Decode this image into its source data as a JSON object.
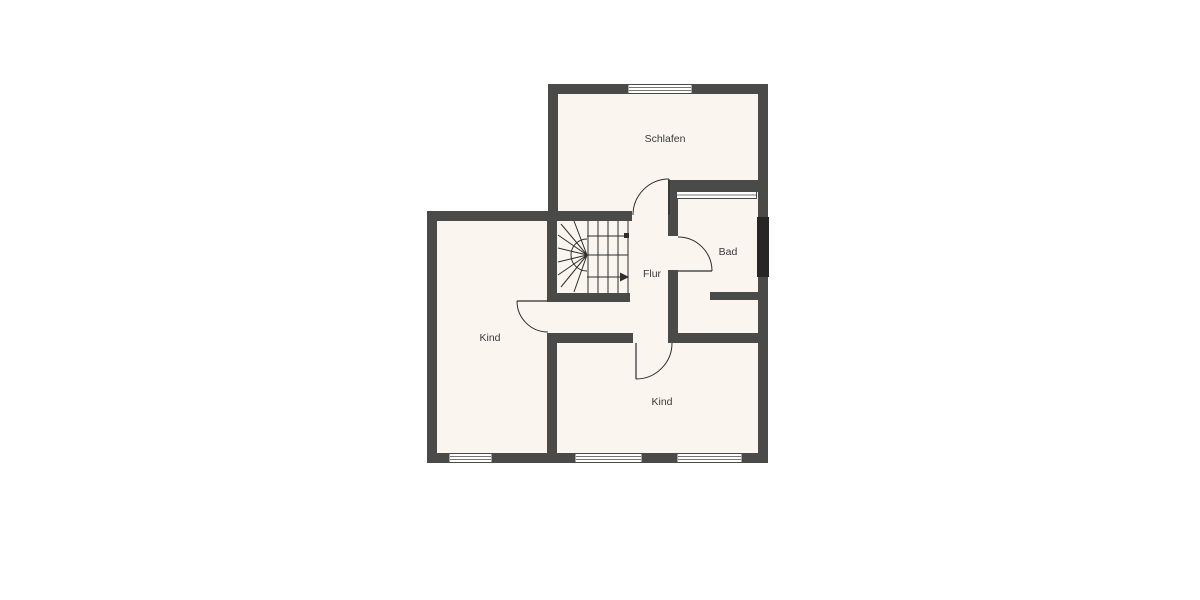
{
  "floorplan": {
    "rooms": [
      {
        "id": "schlafen",
        "label": "Schlafen"
      },
      {
        "id": "bad",
        "label": "Bad"
      },
      {
        "id": "flur",
        "label": "Flur"
      },
      {
        "id": "kind-west",
        "label": "Kind"
      },
      {
        "id": "kind-sued",
        "label": "Kind"
      }
    ],
    "features": {
      "doors": 4,
      "windows": 5,
      "staircase": "winder-stair-u-turn"
    },
    "colors": {
      "wall": "#4a4a48",
      "floor": "#faf5ef",
      "background": "#ffffff",
      "line": "#2e2e2e",
      "label": "#3a3a3a",
      "flue": "#262626",
      "window_fill": "#ffffff"
    }
  }
}
